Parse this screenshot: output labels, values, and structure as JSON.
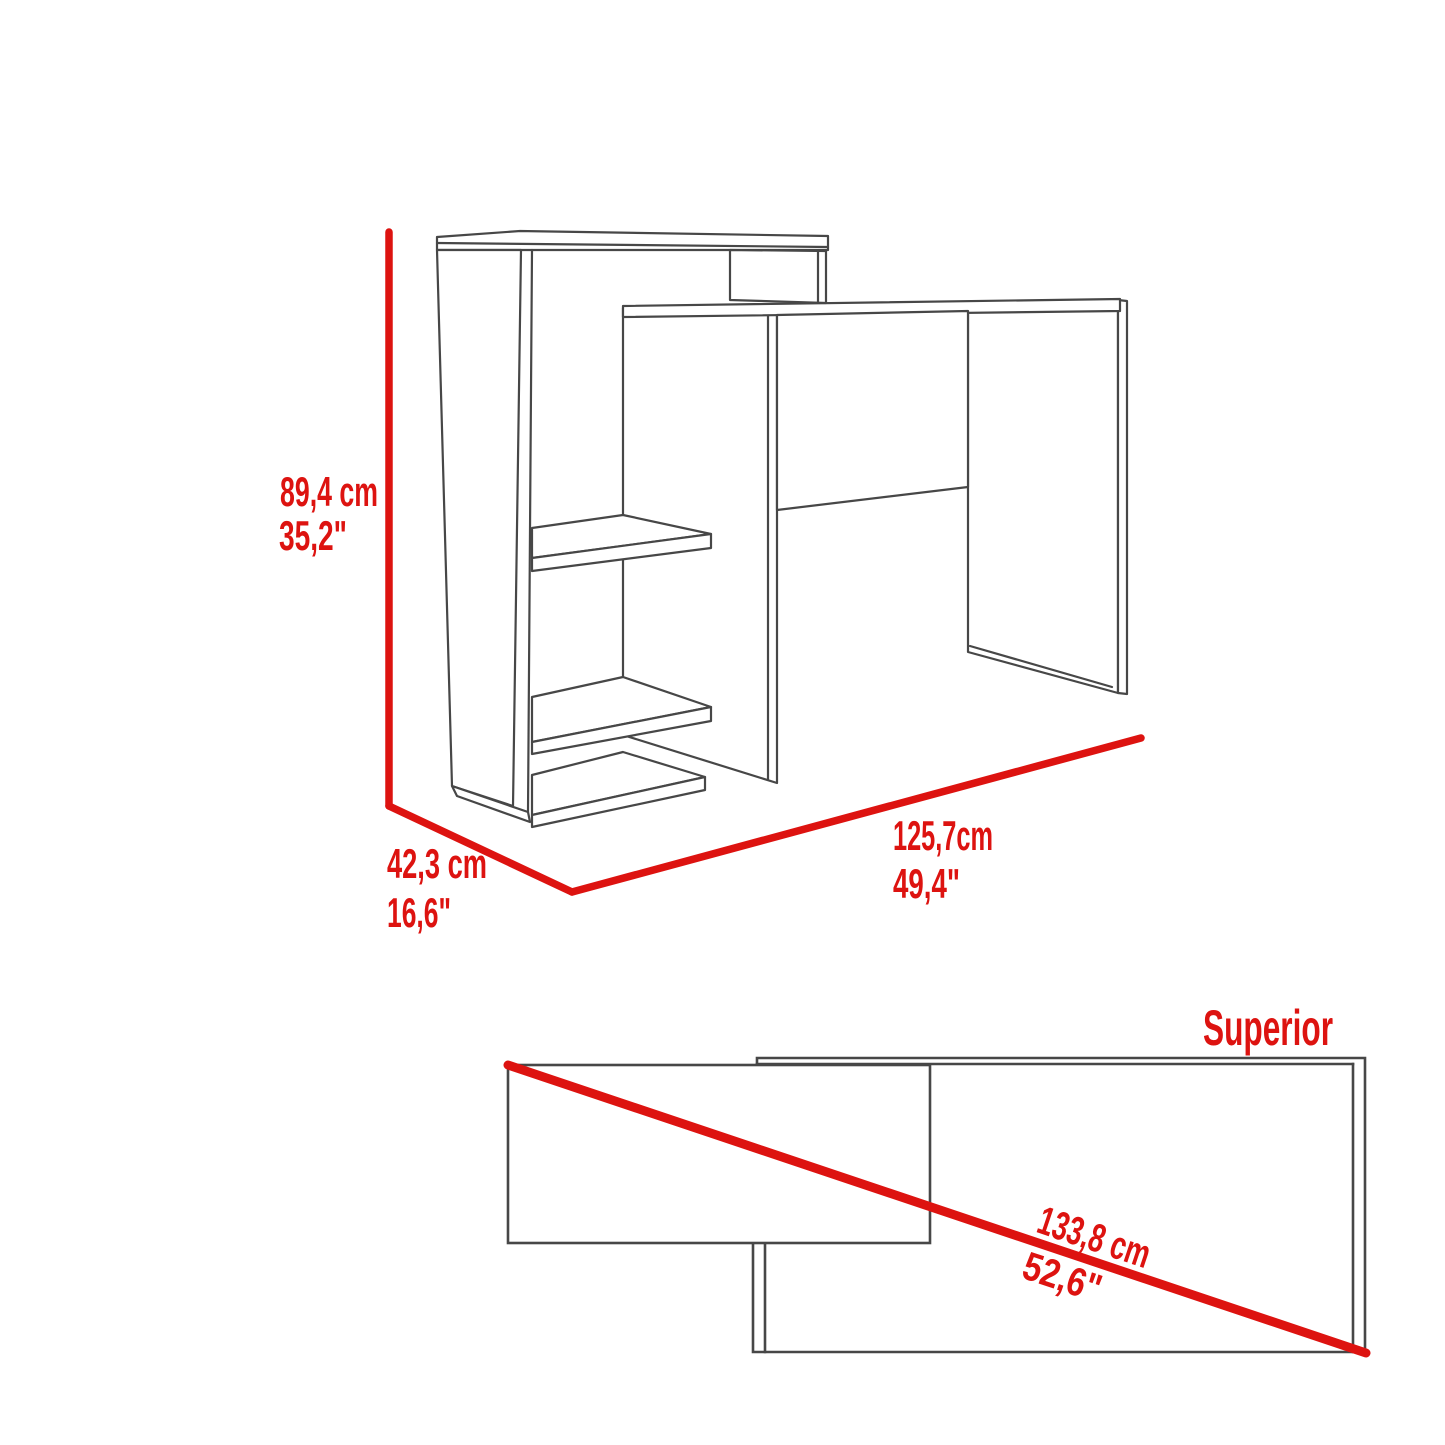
{
  "figure": {
    "front_view": {
      "height_cm": "89,4 cm",
      "height_in": "35,2\"",
      "depth_cm": "42,3 cm",
      "depth_in": "16,6\"",
      "width_cm": "125,7cm",
      "width_in": "49,4\""
    },
    "top_view": {
      "title": "Superior",
      "diagonal_cm": "133,8 cm",
      "diagonal_in": "52,6\""
    }
  },
  "colors": {
    "dimension_red": "#dd1310",
    "outline_gray": "#474747",
    "background": "#ffffff"
  }
}
